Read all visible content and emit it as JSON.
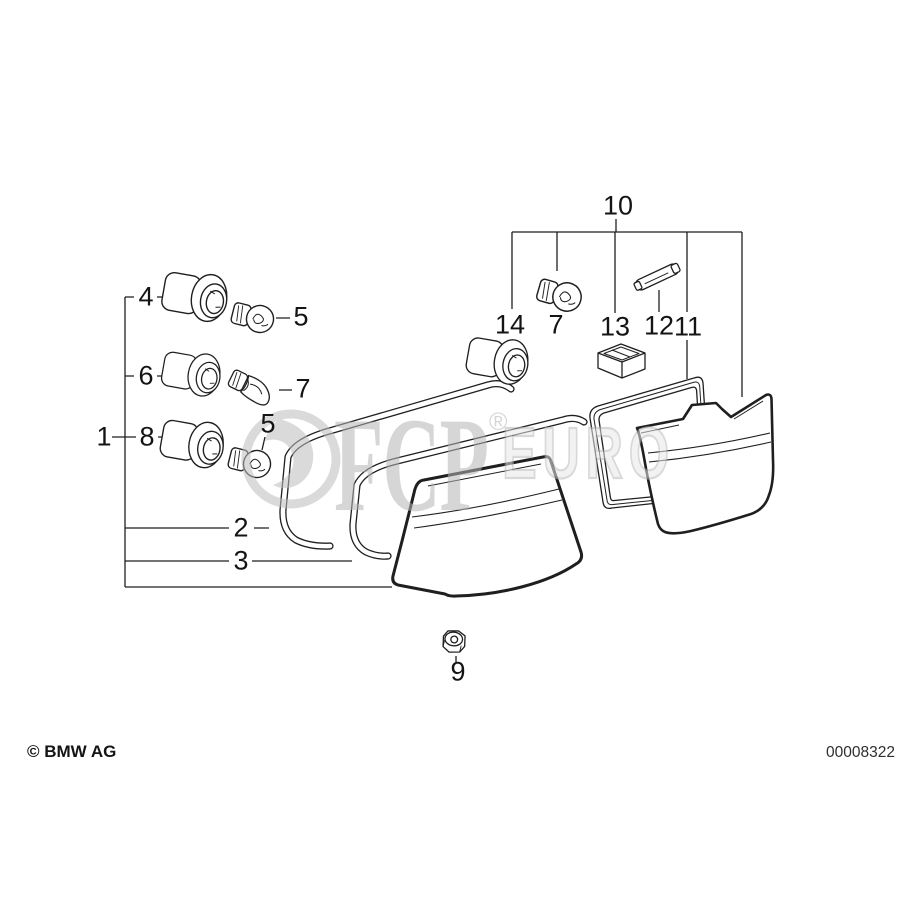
{
  "watermark": {
    "brand": "FCP",
    "registered": "®",
    "brand_suffix": "EURO"
  },
  "footer": {
    "copyright": "© BMW AG",
    "diagram_number": "00008322"
  },
  "callouts": {
    "c1": "1",
    "c2": "2",
    "c3": "3",
    "c4": "4",
    "c5_top": "5",
    "c5_bottom": "5",
    "c6": "6",
    "c7_left": "7",
    "c7_top": "7",
    "c8": "8",
    "c9": "9",
    "c10": "10",
    "c11": "11",
    "c12": "12",
    "c13": "13",
    "c14": "14"
  },
  "colors": {
    "line": "#1f1f1f",
    "background": "#ffffff",
    "watermark_gray": "#bdbdbd"
  }
}
